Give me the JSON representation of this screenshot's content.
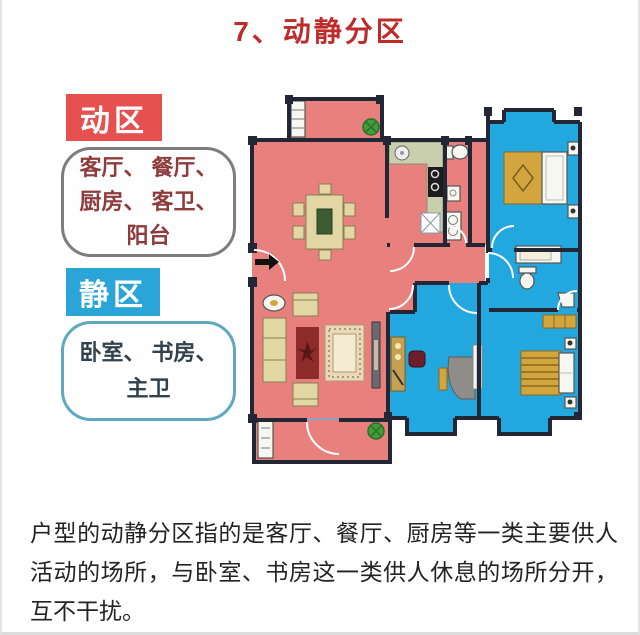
{
  "title": "7、动静分区",
  "legend": {
    "active_badge": "动区",
    "active_rooms": [
      "客厅、 餐厅、",
      "厨房、 客卫、",
      "阳台"
    ],
    "quiet_badge": "静区",
    "quiet_rooms": [
      "卧室、 书房、",
      "主卫"
    ]
  },
  "paragraph": "户型的动静分区指的是客厅、餐厅、厨房等一类主要供人活动的场所，与卧室、书房这一类供人休息的场所分开，互不干扰。",
  "icons": {
    "entrance": "entrance-arrow",
    "plants": "potted-plant",
    "fixtures": [
      "toilet",
      "sink",
      "bathtub",
      "stove",
      "washer"
    ]
  },
  "colors": {
    "title-red": "#bf2b2b",
    "active-badge": "#e6504f",
    "active-floor": "#e8807e",
    "active-text": "#8e3b3b",
    "quiet-badge": "#2ba5d8",
    "quiet-floor": "#22a7de",
    "quiet-text": "#32414b",
    "wall": "#232735",
    "counter": "#c9cfad",
    "furniture": "#e2d6a4",
    "gold": "#d2a53e",
    "plant": "#3f9e3a",
    "body-text": "#232323"
  }
}
